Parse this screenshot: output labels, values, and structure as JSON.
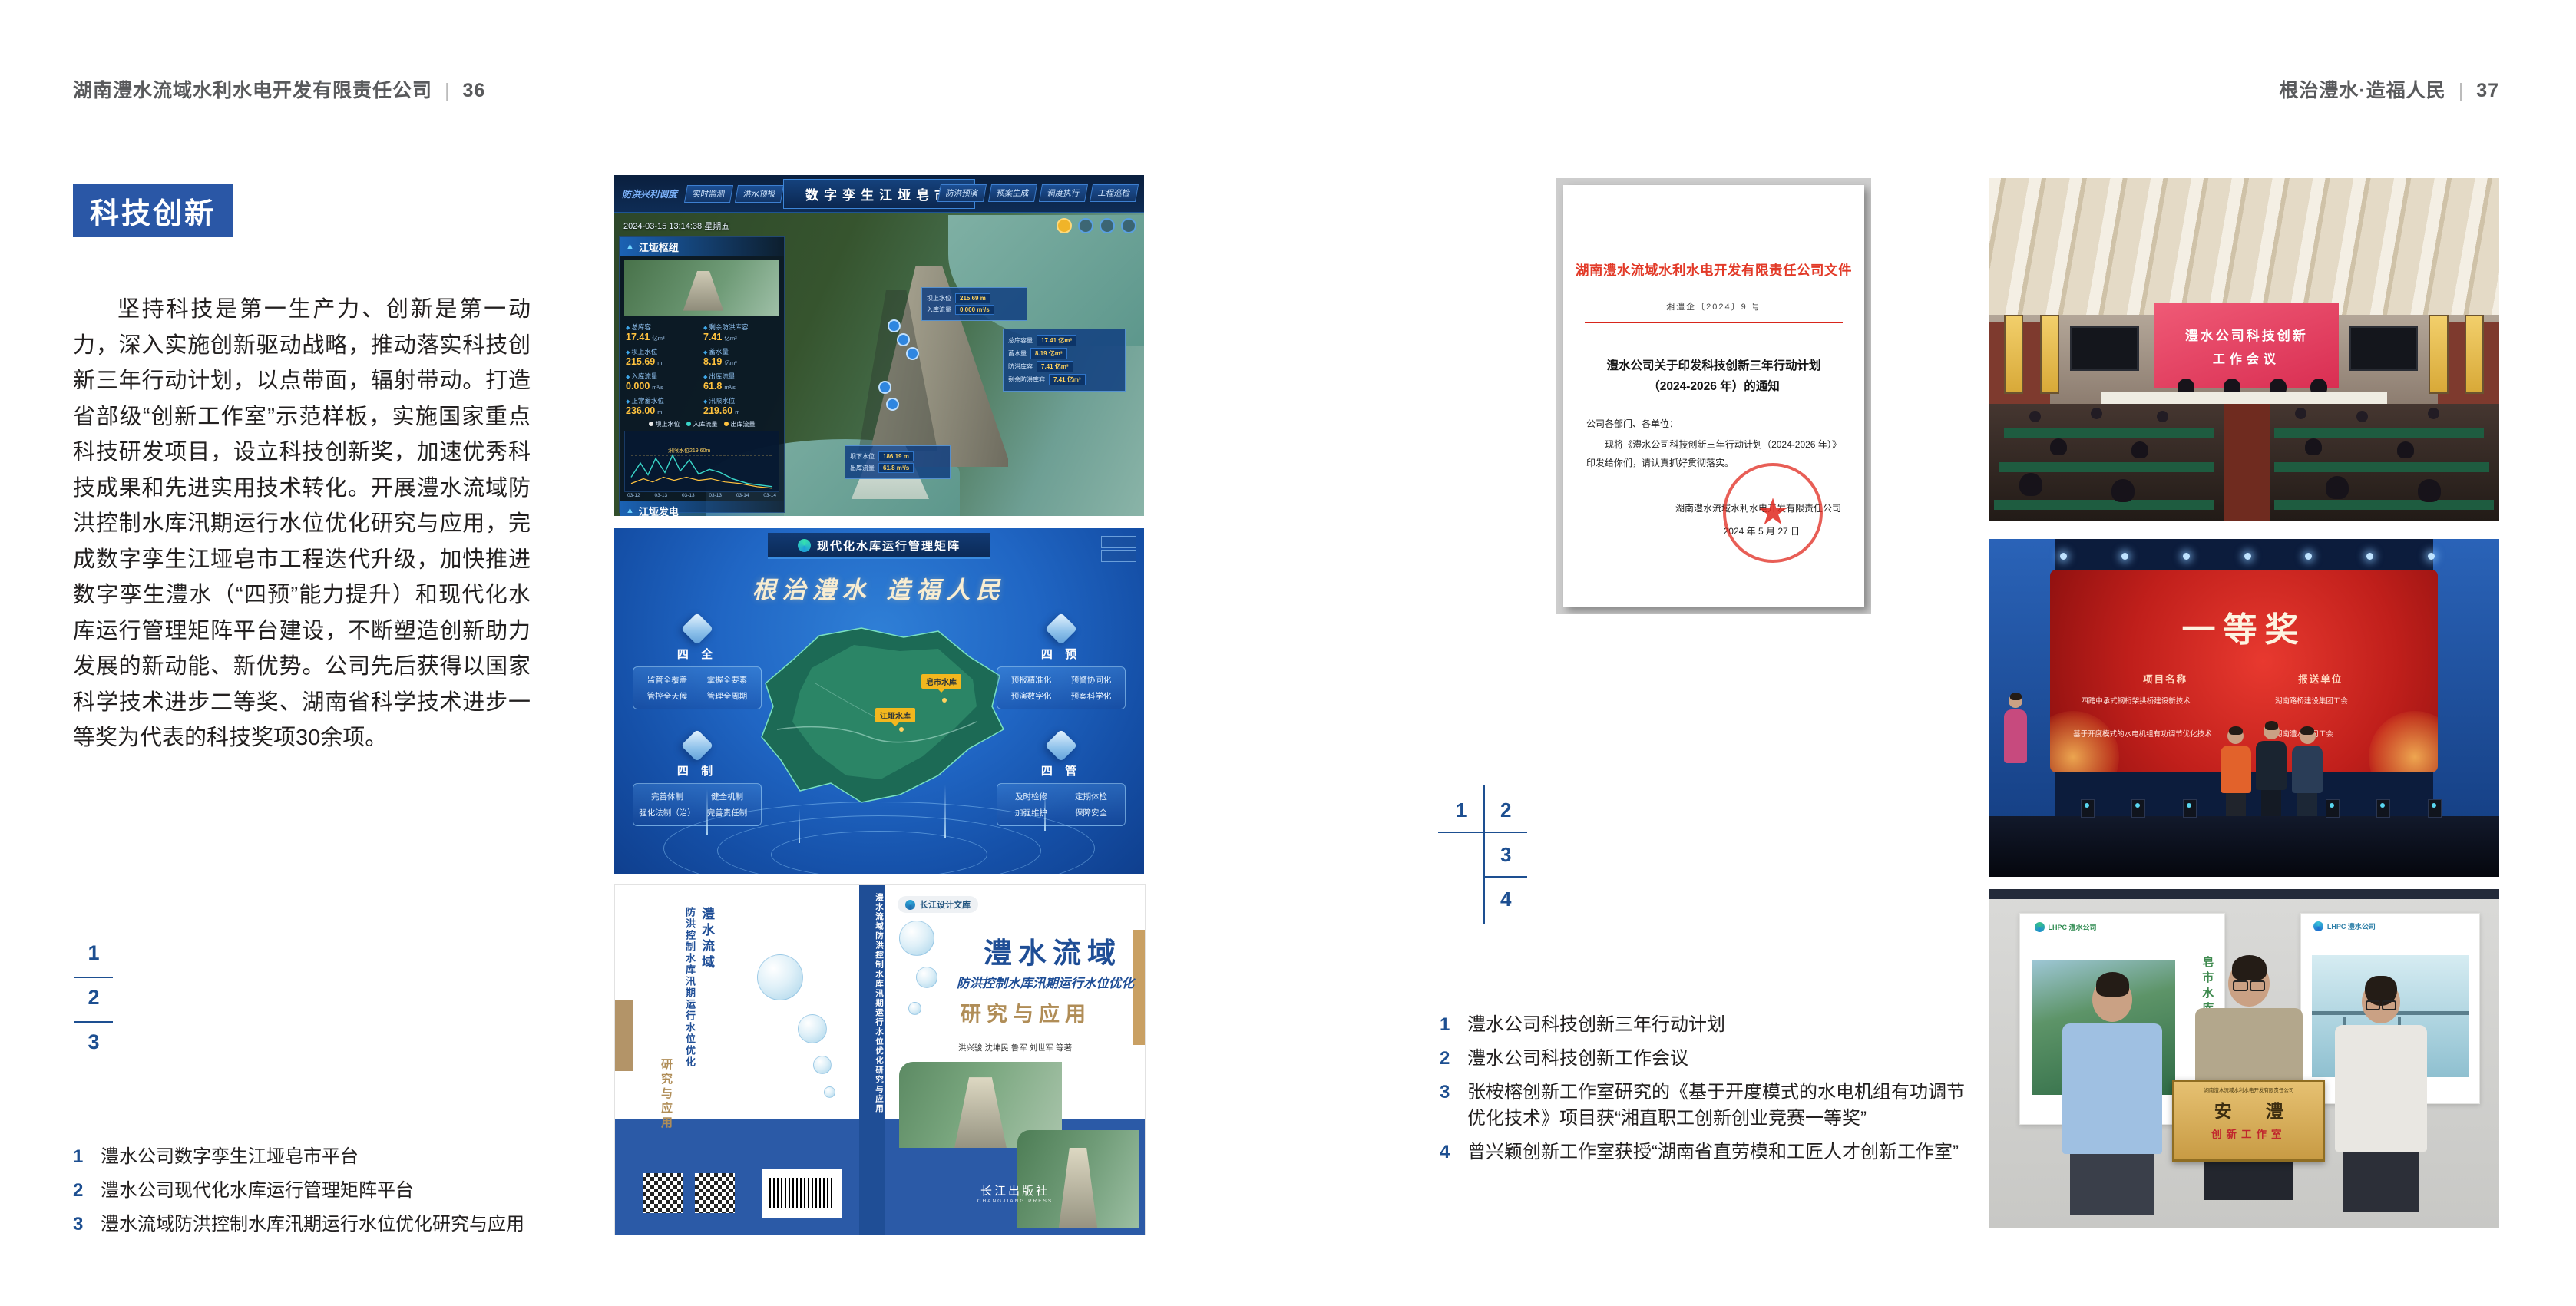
{
  "colors": {
    "accent_blue": "#2a57a6",
    "number_blue": "#1d4f91",
    "doc_red": "#e23a28",
    "matrix_blue": "#2066c4",
    "band_blue": "#2b5aa7"
  },
  "header_left": {
    "title": "湖南澧水流域水利水电开发有限责任公司",
    "sep": "|",
    "page_num": "36"
  },
  "header_right": {
    "title": "根治澧水·造福人民",
    "sep": "|",
    "page_num": "37"
  },
  "left_page": {
    "badge": "科技创新",
    "body": "坚持科技是第一生产力、创新是第一动力，深入实施创新驱动战略，推动落实科技创新三年行动计划，以点带面，辐射带动。打造省部级“创新工作室”示范样板，实施国家重点科技研发项目，设立科技创新奖，加速优秀科技成果和先进实用技术转化。开展澧水流域防洪控制水库汛期运行水位优化研究与应用，完成数字孪生江垭皂市工程迭代升级，加快推进数字孪生澧水（“四预”能力提升）和现代化水库运行管理矩阵平台建设，不断塑造创新助力发展的新动能、新优势。公司先后获得以国家科学技术进步二等奖、湖南省科学技术进步一等奖为代表的科技奖项30余项。",
    "fig_nums": {
      "n1": "1",
      "n2": "2",
      "n3": "3"
    },
    "captions": [
      {
        "num": "1",
        "text": "澧水公司数字孪生江垭皂市平台"
      },
      {
        "num": "2",
        "text": "澧水公司现代化水库运行管理矩阵平台"
      },
      {
        "num": "3",
        "text": "澧水流域防洪控制水库汛期运行水位优化研究与应用"
      }
    ]
  },
  "dashboard": {
    "title": "数字孪生江垭皂市",
    "section_label": "防洪兴利调度",
    "tabs_left": [
      "实时监测",
      "洪水预报",
      "防洪预警"
    ],
    "tabs_right": [
      "防洪预演",
      "预案生成",
      "调度执行",
      "工程巡检"
    ],
    "timestamp": "2024-03-15 13:14:38 星期五",
    "panel1_title": "江垭枢纽",
    "stats": [
      {
        "l": "总库容",
        "v": "17.41",
        "u": "亿m³"
      },
      {
        "l": "剩余防洪库容",
        "v": "7.41",
        "u": "亿m³"
      },
      {
        "l": "坝上水位",
        "v": "215.69",
        "u": "m"
      },
      {
        "l": "蓄水量",
        "v": "8.19",
        "u": "亿m³"
      },
      {
        "l": "入库流量",
        "v": "0.000",
        "u": "m³/s"
      },
      {
        "l": "出库流量",
        "v": "61.8",
        "u": "m³/s"
      },
      {
        "l": "正常蓄水位",
        "v": "236.00",
        "u": "m"
      },
      {
        "l": "汛限水位",
        "v": "219.60",
        "u": "m"
      }
    ],
    "legend": [
      "坝上水位",
      "入库流量",
      "出库流量"
    ],
    "chart_note": "汛限水位219.60m",
    "chart_x": [
      "03-12",
      "03-13",
      "03-13",
      "03-13",
      "03-14",
      "03-14"
    ],
    "panel2_title": "江垭发电",
    "power_stats": [
      {
        "l": "年发电计划",
        "v": "6.3000",
        "u": "亿度"
      },
      {
        "l": "年累计发电量",
        "v": "1.2907",
        "u": "亿度"
      },
      {
        "l": "月累计发电量",
        "v": "3359.21",
        "u": "万度"
      },
      {
        "l": "当前总出力",
        "v": "0.00",
        "u": "(MW)"
      },
      {
        "l": "发电流量",
        "v": "0.00",
        "u": "m³/s"
      },
      {
        "l": "弃水流量",
        "v": "0.00",
        "u": "m³/s"
      }
    ],
    "gauges": [
      "0.00",
      "100.98",
      "0.00"
    ],
    "tip_up": {
      "r1l": "坝上水位",
      "r1v": "215.69 m",
      "r2l": "入库流量",
      "r2v": "0.000 m³/s"
    },
    "tip_right": [
      {
        "l": "总库容量",
        "v": "17.41 亿m³"
      },
      {
        "l": "蓄水量",
        "v": "8.19 亿m³"
      },
      {
        "l": "防洪库容",
        "v": "7.41 亿m³"
      },
      {
        "l": "剩余防洪库容",
        "v": "7.41 亿m³"
      }
    ],
    "tip_down": {
      "r1l": "坝下水位",
      "r1v": "186.19 m",
      "r2l": "出库流量",
      "r2v": "61.8 m³/s"
    }
  },
  "matrix": {
    "logo_text": "LHPC 澧水公司",
    "title": "现代化水库运行管理矩阵",
    "slogan": "根治澧水 造福人民",
    "map_labels": [
      "皂市水库",
      "江垭水库"
    ],
    "panels": [
      {
        "title": "四 全",
        "items": [
          "监管全覆盖",
          "掌握全要素",
          "管控全天候",
          "管理全周期"
        ]
      },
      {
        "title": "四 预",
        "items": [
          "预报精准化",
          "预警协同化",
          "预演数字化",
          "预案科学化"
        ]
      },
      {
        "title": "四 制",
        "items": [
          "完善体制",
          "健全机制",
          "强化法制（治）",
          "完善责任制"
        ]
      },
      {
        "title": "四 管",
        "items": [
          "及时检修",
          "定期体检",
          "加强维护",
          "保障安全"
        ]
      }
    ]
  },
  "book": {
    "series": "长江设计文库",
    "title1": "澧水流域",
    "title2": "防洪控制水库汛期运行水位优化",
    "title3": "研究与应用",
    "authors": "洪兴骏  沈坤民  鲁军  刘世军  等著",
    "publisher": "长江出版社",
    "publisher_en": "CHANGJIANG PRESS",
    "spine": "澧水流域防洪控制水库汛期运行水位优化研究与应用"
  },
  "document": {
    "header": "湖南澧水流域水利水电开发有限责任公司文件",
    "doc_no": "湘澧企〔2024〕9 号",
    "title": "澧水公司关于印发科技创新三年行动计划（2024-2026 年）的通知",
    "salutation": "公司各部门、各单位：",
    "body": "现将《澧水公司科技创新三年行动计划（2024-2026 年）》印发给你们，请认真抓好贯彻落实。",
    "sign1": "湖南澧水流域水利水电开发有限责任公司",
    "sign2": "2024 年 5 月 27 日",
    "seal_star": "★"
  },
  "meeting": {
    "screen_line1": "澧水公司科技创新",
    "screen_line2": "工作会议"
  },
  "award": {
    "title": "一等奖",
    "col1": "项目名称",
    "col2": "报送单位",
    "rows": [
      {
        "project": "四跨中承式钢桁架拱桥建设新技术",
        "unit": "湖南路桥建设集团工会"
      },
      {
        "project": "基于开度模式的水电机组有功调节优化技术",
        "unit": "湖南澧水公司工会"
      }
    ]
  },
  "workshop": {
    "poster_left_text": "皂市水库",
    "logo_text": "LHPC 澧水公司",
    "plaque_top": "湖南澧水流域水利水电开发有限责任公司",
    "plaque_main": "安 澧",
    "plaque_sub": "创新工作室"
  },
  "right_page": {
    "fig_map": {
      "n1": "1",
      "n2": "2",
      "n3": "3",
      "n4": "4"
    },
    "captions": [
      {
        "num": "1",
        "text": "澧水公司科技创新三年行动计划"
      },
      {
        "num": "2",
        "text": "澧水公司科技创新工作会议"
      },
      {
        "num": "3",
        "text": "张桉榕创新工作室研究的《基于开度模式的水电机组有功调节优化技术》项目获“湘直职工创新创业竞赛一等奖”"
      },
      {
        "num": "4",
        "text": "曾兴颖创新工作室获授“湖南省直劳模和工匠人才创新工作室”"
      }
    ]
  }
}
